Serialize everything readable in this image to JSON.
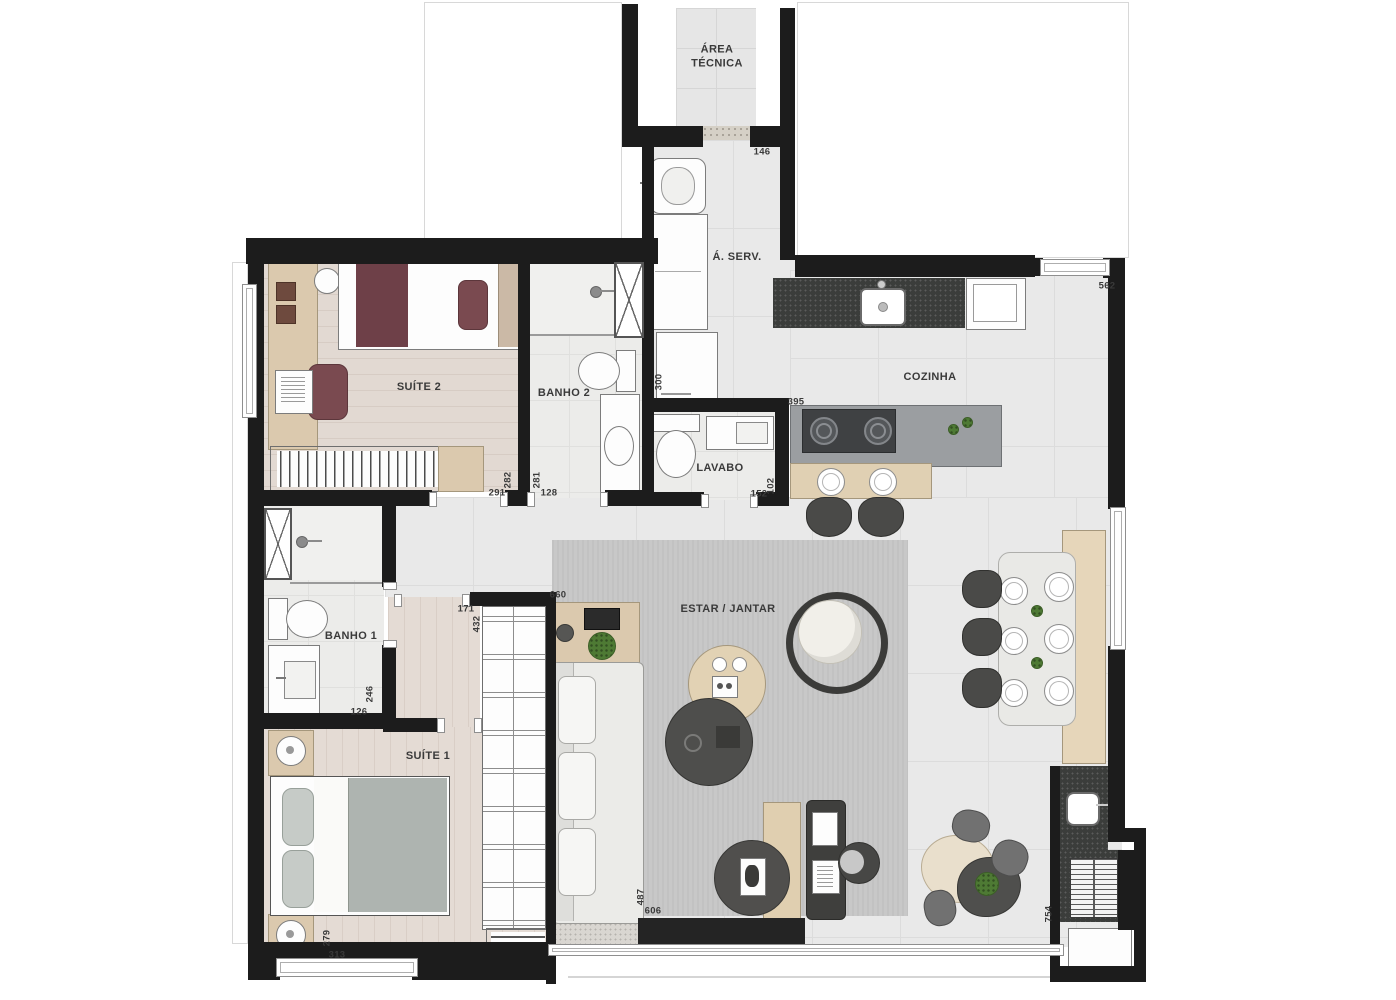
{
  "plan": {
    "type": "apartment-floor-plan",
    "palette": {
      "wall": "#1c1c1c",
      "floor_tile": "#e9e9e9",
      "rug": "#c8c8c8",
      "wood": "#dbc9ae",
      "wood_floor": "#e4dbd4",
      "granite": "#3b3d3b",
      "maroon": "#6e4048",
      "duvet_gray": "#b0b5b1",
      "dark_furniture": "#4a4a48",
      "plant_green": "#4e7a34"
    },
    "rooms": [
      {
        "id": "area-tecnica",
        "label": "ÁREA\nTÉCNICA",
        "x": 717,
        "y": 57,
        "w": 70
      },
      {
        "id": "a-serv",
        "label": "Á. SERV.",
        "x": 737,
        "y": 257
      },
      {
        "id": "cozinha",
        "label": "COZINHA",
        "x": 930,
        "y": 377
      },
      {
        "id": "suite-2",
        "label": "SUÍTE 2",
        "x": 419,
        "y": 387
      },
      {
        "id": "banho-2",
        "label": "BANHO 2",
        "x": 564,
        "y": 393
      },
      {
        "id": "lavabo",
        "label": "LAVABO",
        "x": 720,
        "y": 468
      },
      {
        "id": "banho-1",
        "label": "BANHO 1",
        "x": 351,
        "y": 636
      },
      {
        "id": "suite-1",
        "label": "SUÍTE 1",
        "x": 428,
        "y": 756
      },
      {
        "id": "estar-jantar",
        "label": "ESTAR / JANTAR",
        "x": 728,
        "y": 609
      }
    ],
    "dimensions": [
      {
        "value": "146",
        "x": 762,
        "y": 152,
        "v": false
      },
      {
        "value": "562",
        "x": 1107,
        "y": 286,
        "v": false
      },
      {
        "value": "300",
        "x": 659,
        "y": 382,
        "v": true
      },
      {
        "value": "395",
        "x": 796,
        "y": 402,
        "v": false
      },
      {
        "value": "291",
        "x": 497,
        "y": 493,
        "v": false
      },
      {
        "value": "282",
        "x": 508,
        "y": 480,
        "v": true
      },
      {
        "value": "281",
        "x": 537,
        "y": 480,
        "v": true
      },
      {
        "value": "128",
        "x": 549,
        "y": 493,
        "v": false
      },
      {
        "value": "152",
        "x": 759,
        "y": 494,
        "v": false
      },
      {
        "value": "102",
        "x": 771,
        "y": 486,
        "v": true
      },
      {
        "value": "171",
        "x": 466,
        "y": 609,
        "v": false
      },
      {
        "value": "432",
        "x": 477,
        "y": 624,
        "v": true
      },
      {
        "value": "660",
        "x": 558,
        "y": 595,
        "v": false
      },
      {
        "value": "246",
        "x": 370,
        "y": 694,
        "v": true
      },
      {
        "value": "126",
        "x": 359,
        "y": 712,
        "v": false
      },
      {
        "value": "279",
        "x": 327,
        "y": 938,
        "v": true
      },
      {
        "value": "313",
        "x": 337,
        "y": 955,
        "v": false
      },
      {
        "value": "487",
        "x": 641,
        "y": 897,
        "v": true
      },
      {
        "value": "606",
        "x": 653,
        "y": 911,
        "v": false
      },
      {
        "value": "754",
        "x": 1049,
        "y": 914,
        "v": true
      }
    ]
  }
}
